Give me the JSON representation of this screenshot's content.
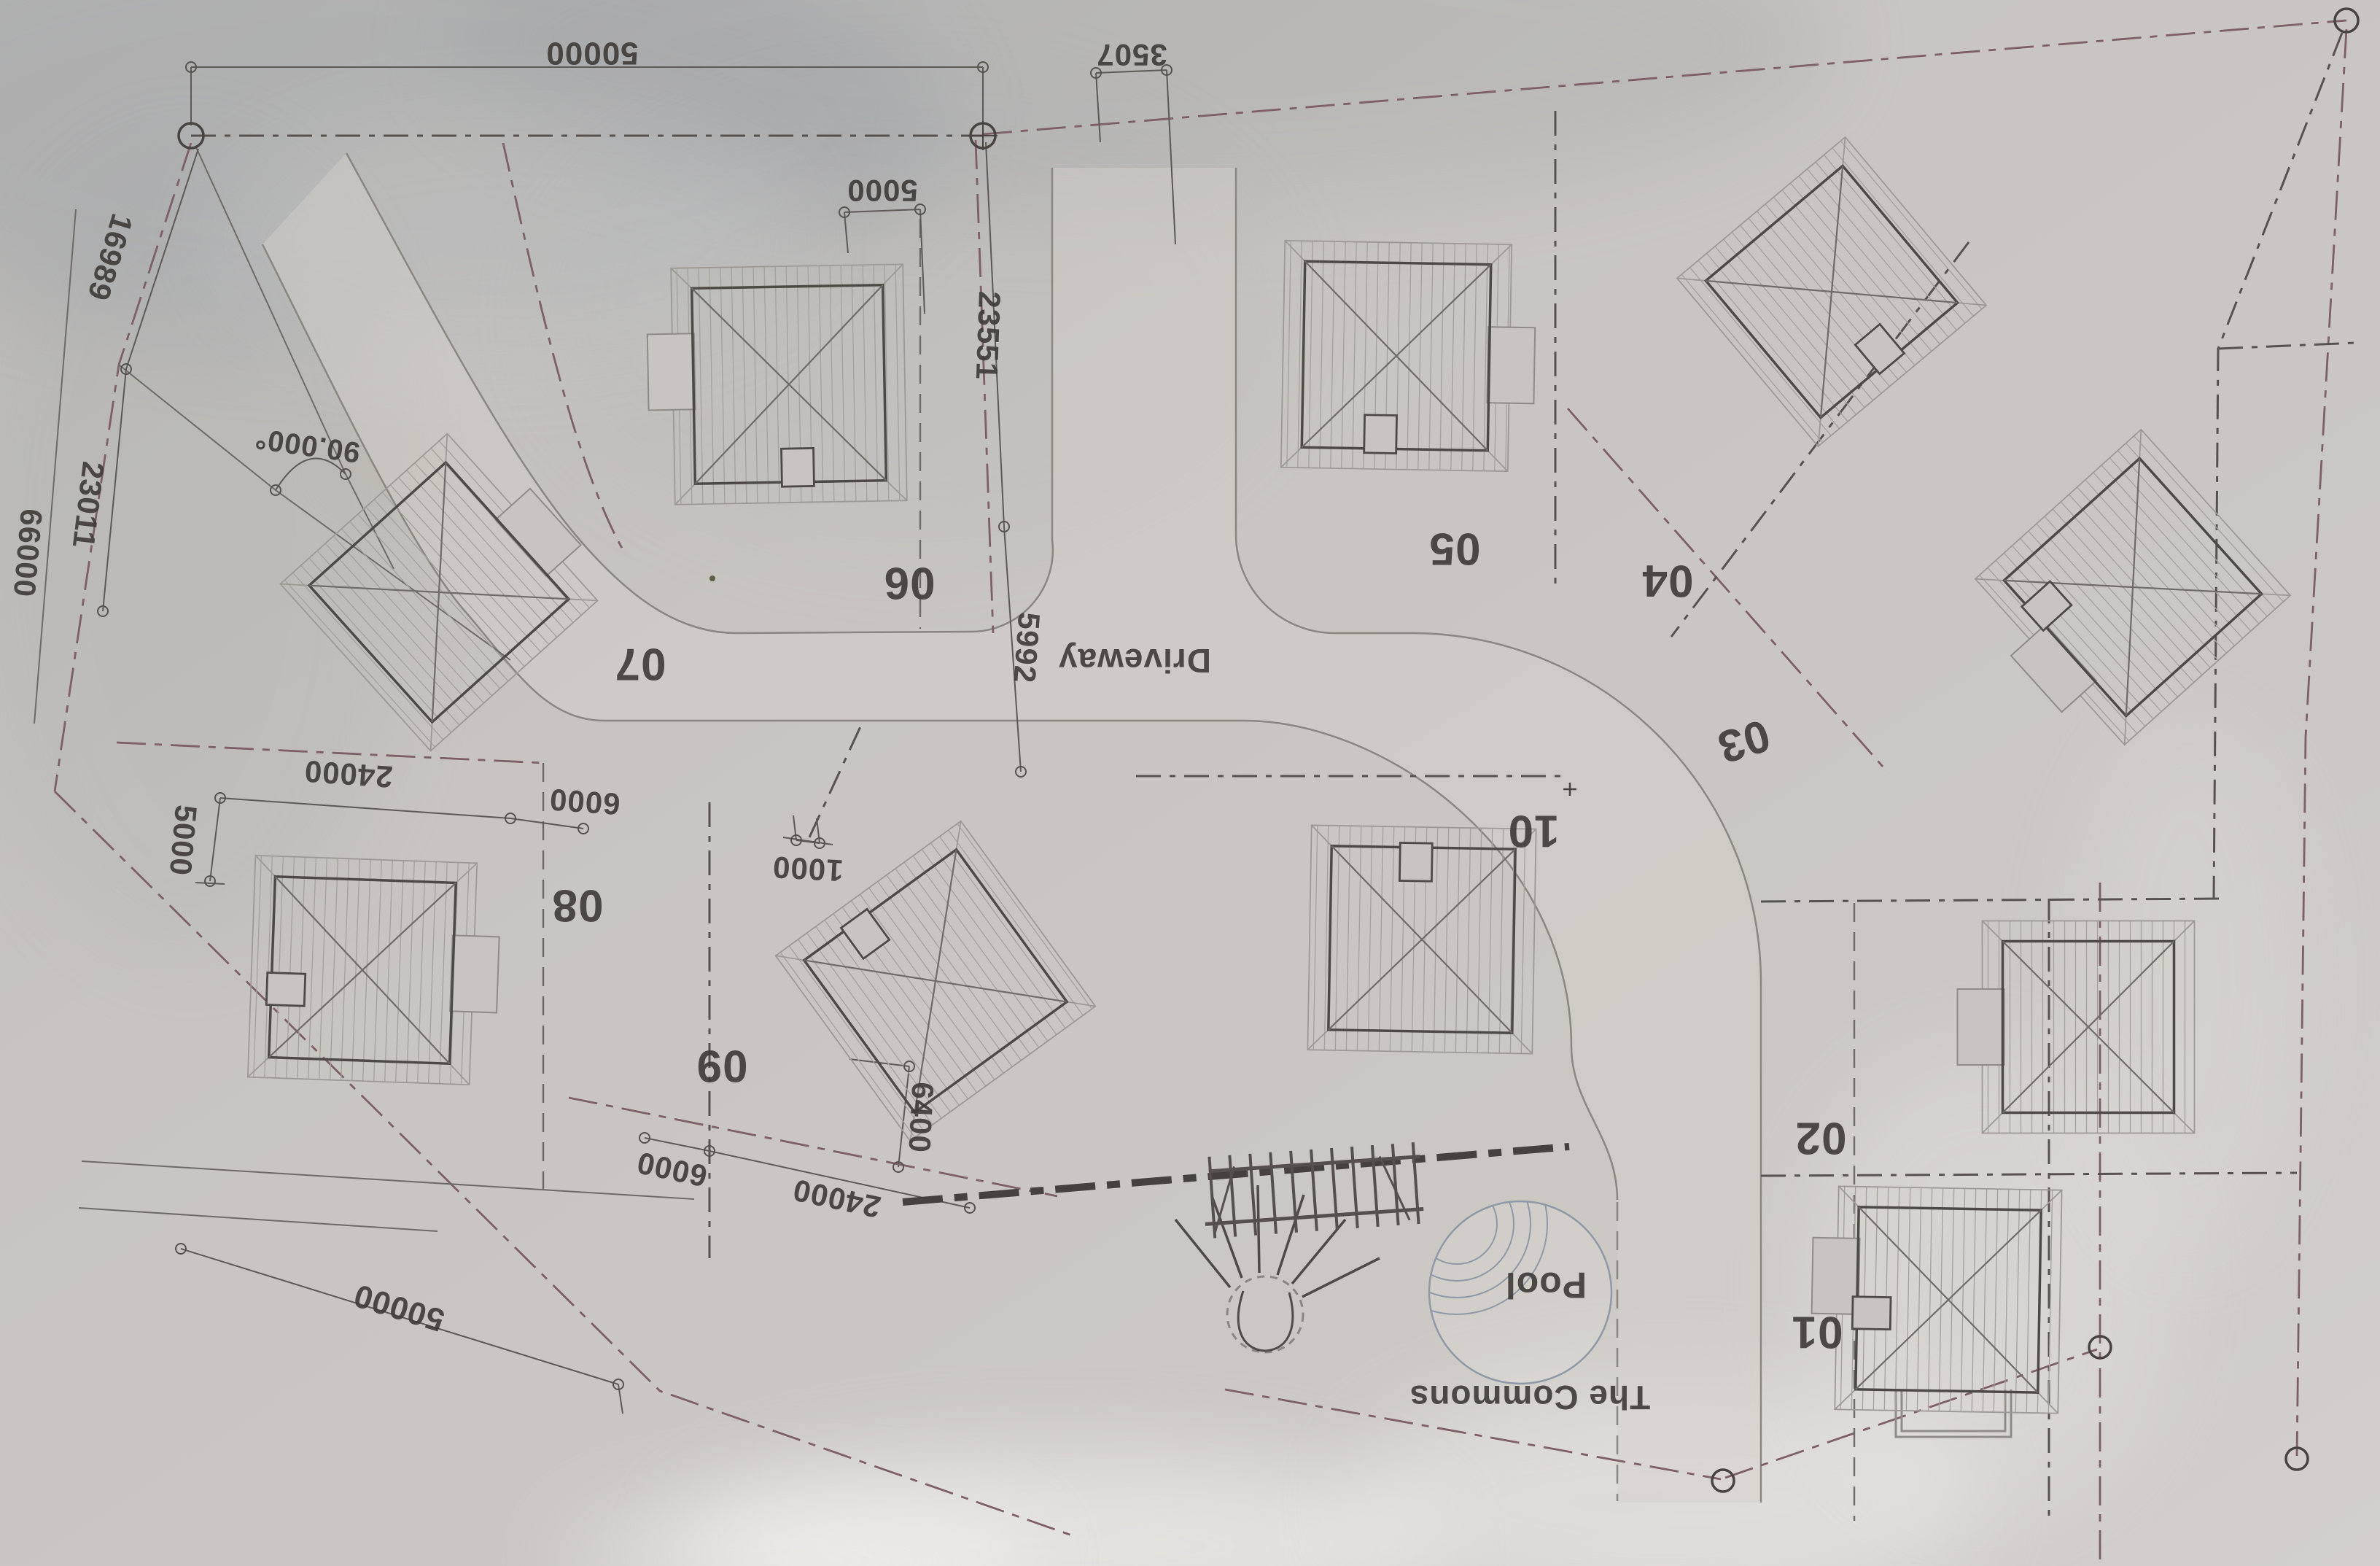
{
  "plan": {
    "driveway_label": "Driveway",
    "pool_label": "Pool",
    "commons_label": "The Commons",
    "lot_numbers": [
      "01",
      "02",
      "03",
      "04",
      "05",
      "06",
      "07",
      "08",
      "09",
      "10"
    ],
    "dimensions": {
      "boundary_top": "50000",
      "offset_top": "3507",
      "lot06_setback": "5000",
      "entry_east_depth": "23551",
      "entry_curve": "5992",
      "west_upper": "16989",
      "west_lower": "23011",
      "west_total": "66000",
      "corner_angle": "90.000°",
      "lot08_frontage": "24000",
      "lot08_setback": "5000",
      "lot08_gap": "6000",
      "lot09_offset": "1000",
      "lot09_gap": "6000",
      "lot09_frontage": "24000",
      "lot09_depth": "6400",
      "boundary_south": "50000"
    }
  }
}
